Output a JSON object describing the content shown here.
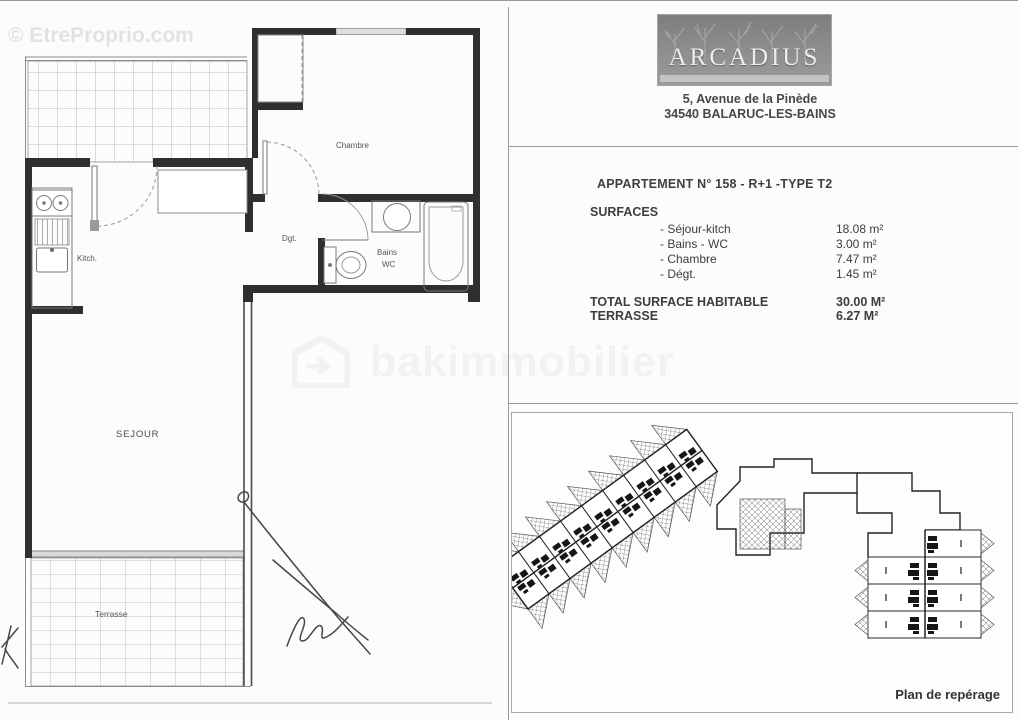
{
  "watermarks": {
    "top_left": "© EtreProprio.com",
    "center": "bakimmobilier"
  },
  "header": {
    "logo_text": "ARCADIUS",
    "address_line1": "5, Avenue de la Pinède",
    "address_line2": "34540 BALARUC-LES-BAINS"
  },
  "apartment": {
    "title": "APPARTEMENT N° 158 - R+1 -TYPE T2",
    "surfaces_heading": "SURFACES",
    "items": [
      {
        "label": "- Séjour-kitch",
        "value": "18.08 m²"
      },
      {
        "label": "- Bains - WC",
        "value": "3.00 m²"
      },
      {
        "label": "- Chambre",
        "value": "7.47 m²"
      },
      {
        "label": "- Dégt.",
        "value": "1.45 m²"
      }
    ],
    "total_label": "TOTAL SURFACE HABITABLE",
    "total_value": "30.00 M²",
    "terrace_label": "TERRASSE",
    "terrace_value": "6.27 M²"
  },
  "floorplan": {
    "labels": {
      "chambre": "Chambre",
      "dgt": "Dgt.",
      "bains": "Bains",
      "wc": "WC",
      "kitch": "Kitch.",
      "sejour": "SEJOUR",
      "terrasse": "Terrasse"
    }
  },
  "siteplan": {
    "caption": "Plan de repérage"
  },
  "colors": {
    "wall": "#2f2f2f",
    "thin_line": "#8a8a8a",
    "tile_line": "#adadad",
    "text": "#3d3d3d",
    "watermark_light": "#e2e2e2",
    "logo_bg": "#8d8d8d"
  }
}
